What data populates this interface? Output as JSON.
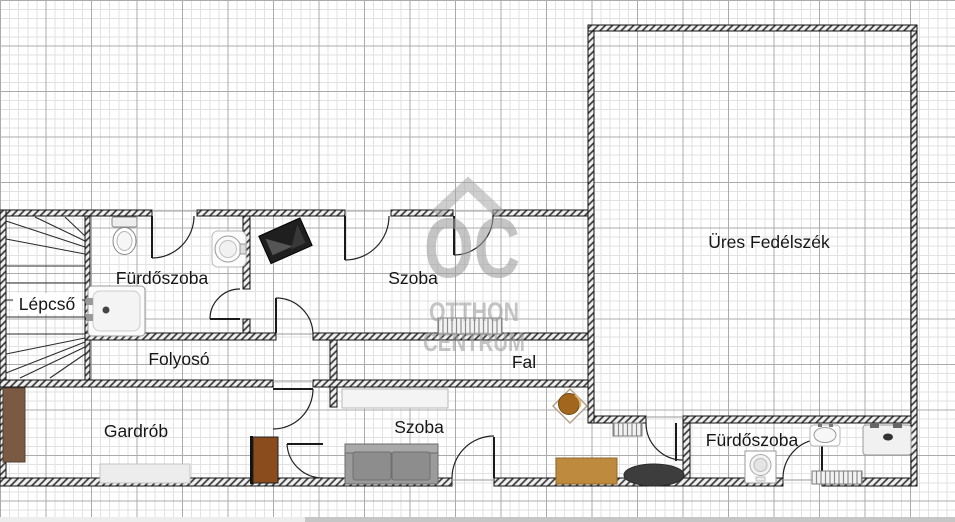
{
  "watermark": {
    "brand": "OC",
    "line1": "OTTHON",
    "line2": "CENTRUM"
  },
  "rooms": {
    "lepcso": "Lépcső",
    "furdoszoba_top": "Fürdőszoba",
    "folyoso": "Folyosó",
    "szoba_top": "Szoba",
    "fal": "Fal",
    "gardrob": "Gardrób",
    "szoba_bottom": "Szoba",
    "furdoszoba_bottom": "Fürdőszoba",
    "ures_fedelszek": "Üres Fedélszék"
  },
  "colors": {
    "wall": "#1a1a1a",
    "grid_minor": "#e2e2e2",
    "grid_major": "#ababab",
    "watermark_gray": "#9c9c9c",
    "wardrobe_brown": "#7b5a44",
    "cabinet_brown": "#8a4b1d",
    "desk_tan": "#bd8a3e",
    "table_plant_brown": "#a2671c",
    "sofa_gray": "#9b9b9b",
    "rug_dark": "#3d3d3d",
    "scroll_track": "#ededed",
    "scroll_thumb": "#c6c6c6"
  }
}
